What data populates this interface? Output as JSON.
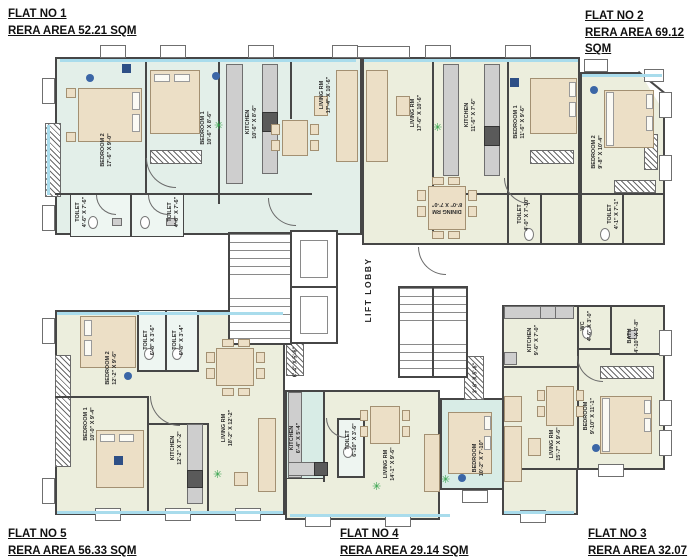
{
  "title": "Typical floor plan with five flats",
  "colors": {
    "wall": "#464646",
    "flat1_floor": "#e3efe9",
    "flat_floor_green": "#eceedd",
    "teal_floor": "#d8ece6",
    "furniture": "#ecdfc6",
    "counter": "#cecece",
    "window_accent": "#a9dcec",
    "plant_green": "#2fa047",
    "fan_dot_blue": "#3b66a6"
  },
  "flat_labels": [
    {
      "name": "FLAT NO 1",
      "area": "RERA AREA 52.21 SQM"
    },
    {
      "name": "FLAT NO 2",
      "area": "RERA AREA 69.12 SQM"
    },
    {
      "name": "FLAT NO 5",
      "area": "RERA AREA 56.33 SQM"
    },
    {
      "name": "FLAT NO 4",
      "area": "RERA AREA 29.14 SQM"
    },
    {
      "name": "FLAT NO 3",
      "area": "RERA AREA 32.07 SQM"
    }
  ],
  "core": {
    "lift_lobby_label": "LIFT LOBBY"
  },
  "rooms": [
    {
      "flat": "1",
      "name": "BEDROOM 2",
      "dims": "17'-6\" X 9'-0\"",
      "x": 107,
      "y": 150,
      "rot": -90
    },
    {
      "flat": "1",
      "name": "BEDROOM 1",
      "dims": "10'-6\" X 8'-6\"",
      "x": 207,
      "y": 128,
      "rot": -90
    },
    {
      "flat": "1",
      "name": "KITCHEN",
      "dims": "10'-6\" X 8'-6\"",
      "x": 252,
      "y": 122,
      "rot": -90
    },
    {
      "flat": "1",
      "name": "LIVING RM",
      "dims": "17'-4\" X 10'-6\"",
      "x": 326,
      "y": 95,
      "rot": -90
    },
    {
      "flat": "1",
      "name": "TOILET",
      "dims": "4'-6\" X 7'-6\"",
      "x": 82,
      "y": 212,
      "rot": -90
    },
    {
      "flat": "1",
      "name": "TOILET",
      "dims": "4'-6\" X 7'-6\"",
      "x": 174,
      "y": 212,
      "rot": -90
    },
    {
      "flat": "2",
      "name": "LIVING RM",
      "dims": "17'-6\" X 10'-6\"",
      "x": 417,
      "y": 113,
      "rot": -90
    },
    {
      "flat": "2",
      "name": "KITCHEN",
      "dims": "11'-6\" X 7'-6\"",
      "x": 471,
      "y": 115,
      "rot": -90
    },
    {
      "flat": "2",
      "name": "BEDROOM 1",
      "dims": "11'-6\" X 9'-6\"",
      "x": 520,
      "y": 122,
      "rot": -90
    },
    {
      "flat": "2",
      "name": "BEDROOM 2",
      "dims": "9'-8\" X 10'-4\"",
      "x": 598,
      "y": 152,
      "rot": -90
    },
    {
      "flat": "2",
      "name": "DINING RM",
      "dims": "8'-0\" X 7'-0\"",
      "x": 447,
      "y": 207,
      "rot": 180
    },
    {
      "flat": "2",
      "name": "TOILET",
      "dims": "4'-0\" X 7'-10\"",
      "x": 524,
      "y": 214,
      "rot": -90
    },
    {
      "flat": "2",
      "name": "TOILET",
      "dims": "4'-1\" X 7'-1\"",
      "x": 614,
      "y": 214,
      "rot": -90
    },
    {
      "flat": "5",
      "name": "BEDROOM 2",
      "dims": "12'-2\" X 9'-6\"",
      "x": 112,
      "y": 368,
      "rot": -90
    },
    {
      "flat": "5",
      "name": "TOILET",
      "dims": "6'-8\" X 3'-6\"",
      "x": 150,
      "y": 340,
      "rot": -90
    },
    {
      "flat": "5",
      "name": "TOILET",
      "dims": "6'-8\" X 3'-4\"",
      "x": 179,
      "y": 340,
      "rot": -90
    },
    {
      "flat": "5",
      "name": "BEDROOM 1",
      "dims": "10'-0\" X 9'-4\"",
      "x": 90,
      "y": 424,
      "rot": -90
    },
    {
      "flat": "5",
      "name": "KITCHEN",
      "dims": "12'-2\" X 7'-2\"",
      "x": 177,
      "y": 448,
      "rot": -90
    },
    {
      "flat": "5",
      "name": "LIVING RM",
      "dims": "18'-2\" X 12'-2\"",
      "x": 228,
      "y": 428,
      "rot": -90
    },
    {
      "flat": "4",
      "name": "KITCHEN",
      "dims": "6'-4\" X 5'-4\"",
      "x": 296,
      "y": 438,
      "rot": -90
    },
    {
      "flat": "4",
      "name": "TOILET",
      "dims": "6'-10\" X 3'-6\"",
      "x": 352,
      "y": 440,
      "rot": -90
    },
    {
      "flat": "4",
      "name": "LIVING RM",
      "dims": "14'-1\" X 9'-6\"",
      "x": 390,
      "y": 464,
      "rot": -90
    },
    {
      "flat": "4",
      "name": "BEDROOM",
      "dims": "10'-2\" X 7'-10\"",
      "x": 479,
      "y": 458,
      "rot": -90
    },
    {
      "flat": "3",
      "name": "KITCHEN",
      "dims": "9'-6\" X 7'-0\"",
      "x": 534,
      "y": 340,
      "rot": -90
    },
    {
      "flat": "3",
      "name": "WC",
      "dims": "4'-6\" X 3'-0\"",
      "x": 587,
      "y": 326,
      "rot": -90
    },
    {
      "flat": "3",
      "name": "BATH",
      "dims": "4'-10\" X 3'-8\"",
      "x": 634,
      "y": 336,
      "rot": -90
    },
    {
      "flat": "3",
      "name": "BEDROOM",
      "dims": "9'-10\" X 11'-1\"",
      "x": 590,
      "y": 416,
      "rot": -90
    },
    {
      "flat": "3",
      "name": "LIVING RM",
      "dims": "15'-7\" X 9'-6\"",
      "x": 556,
      "y": 444,
      "rot": -90
    },
    {
      "flat": "4",
      "name": "",
      "dims": "6'-4\" X 5'-6\"",
      "x": 296,
      "y": 362,
      "rot": -90
    },
    {
      "flat": "3",
      "name": "",
      "dims": "3'-6\" X 5'-6\"",
      "x": 476,
      "y": 378,
      "rot": -90
    }
  ]
}
